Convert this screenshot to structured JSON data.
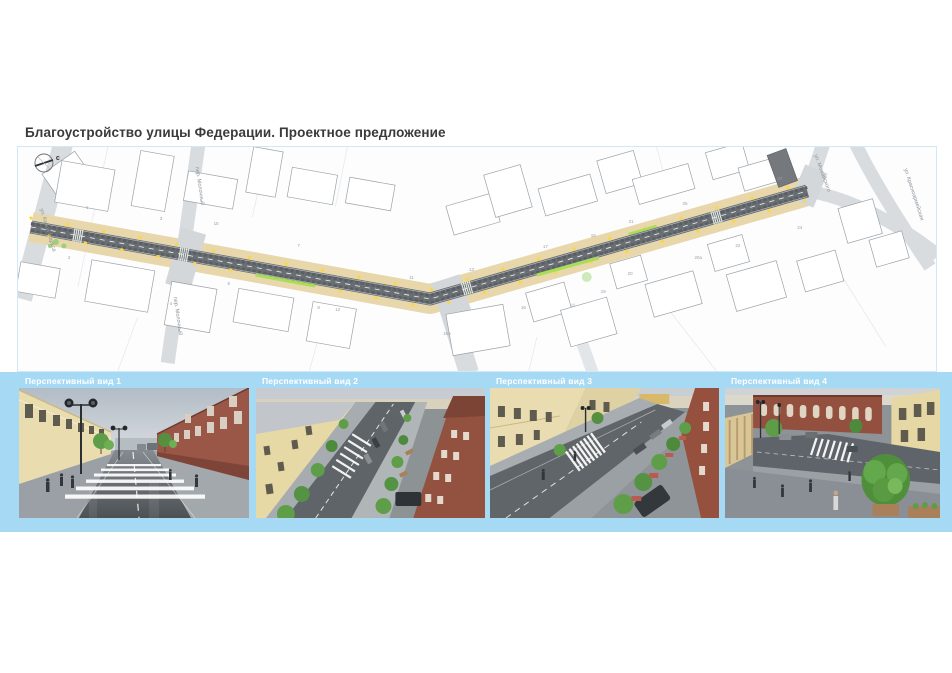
{
  "title": "Благоустройство улицы Федерации. Проектное предложение",
  "map": {
    "north_label": "с",
    "street_labels": {
      "karla_marksa": "ул. Карла Маркса",
      "molochny_top": "пер. Молочный",
      "molochny_bottom": "пер. Молочный",
      "mozhayskogo": "ул. Можайского",
      "krasnoarmeyskaya": "ул. Красноармейская"
    },
    "building_numbers": [
      "1",
      "2",
      "3",
      "4",
      "6",
      "7",
      "8",
      "10",
      "11",
      "12",
      "13",
      "16",
      "16А",
      "17",
      "18",
      "19",
      "20",
      "20а",
      "21",
      "22",
      "24",
      "25",
      "27"
    ]
  },
  "views": [
    {
      "label": "Перспективный вид 1"
    },
    {
      "label": "Перспективный вид 2"
    },
    {
      "label": "Перспективный вид 3"
    },
    {
      "label": "Перспективный вид 4"
    }
  ],
  "colors": {
    "panel_blue": "#a6daf4",
    "map_border": "#cfe9f8",
    "sidewalk_tan": "#e8d7ab",
    "road_gray": "#6a6f74",
    "accent_green": "#a8dd55",
    "lamp_yellow": "#ffd63e",
    "title_text": "#3a3a3a",
    "label_text": "#ffffff"
  }
}
